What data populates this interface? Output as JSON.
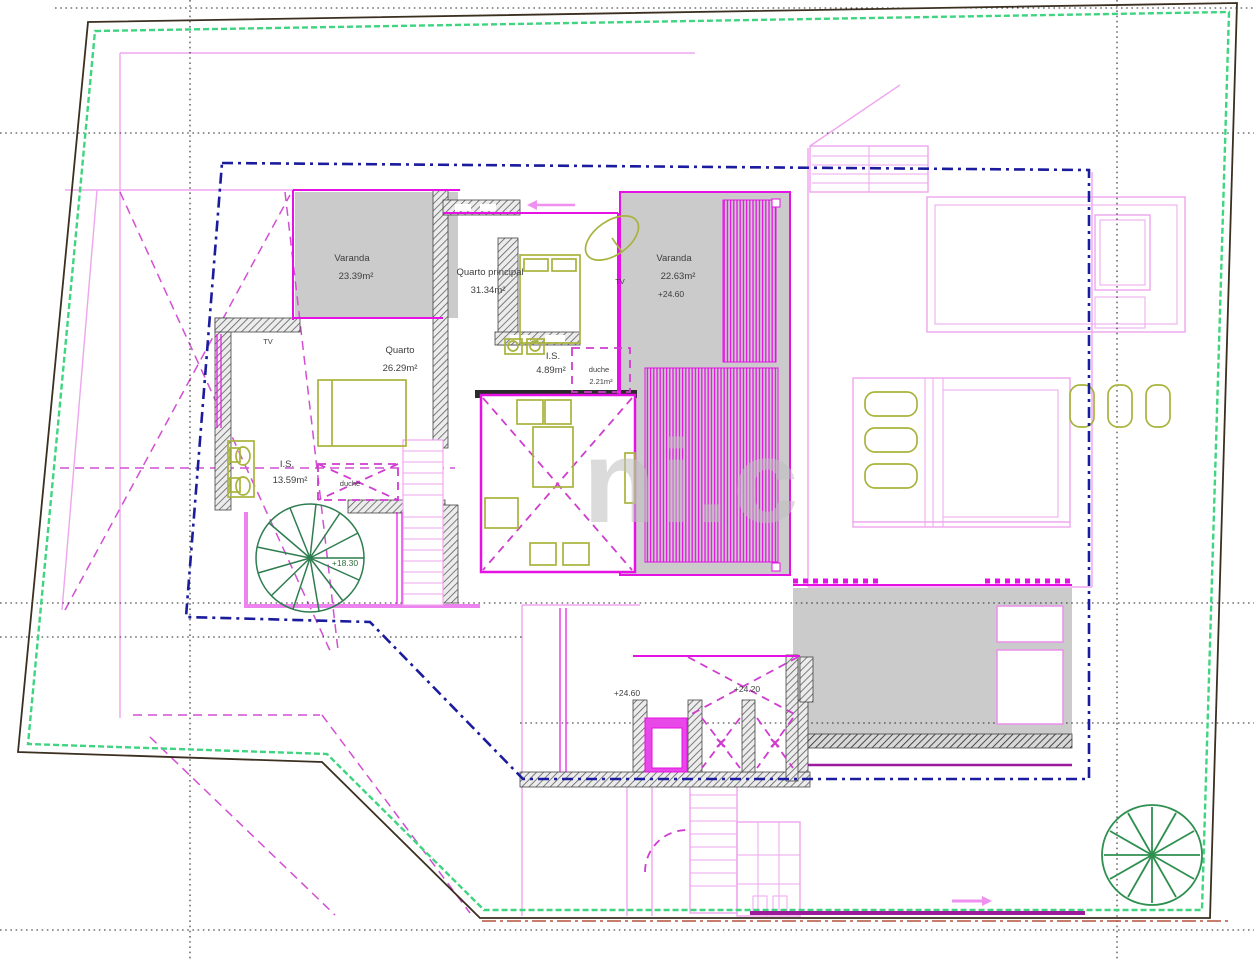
{
  "drawing": {
    "type": "architectural-floor-plan",
    "watermark": "ni.c",
    "rooms": [
      {
        "name": "Varanda",
        "area": "23.39m²"
      },
      {
        "name": "Quarto principal",
        "area": "31.34m²"
      },
      {
        "name": "Varanda",
        "area": "22.63m²",
        "level": "+24.60"
      },
      {
        "name": "Quarto",
        "area": "26.29m²"
      },
      {
        "name": "I.S.",
        "area": "4.89m²"
      },
      {
        "name": "duche",
        "area": "2.21m²"
      },
      {
        "name": "I.S.",
        "area": "13.59m²"
      },
      {
        "name": "duche"
      }
    ],
    "levels": {
      "spiral_stair": "+18.30",
      "hall": "+24.60",
      "upper_void": "+24.20"
    },
    "annotations": {
      "tv": "TV"
    },
    "icons": {
      "tree": "tree-icon",
      "spiral_stair": "spiral-stair-icon",
      "entry_arrow": "arrow-right-icon",
      "door_slide_arrow": "arrow-left-icon"
    },
    "colors": {
      "boundary_green": "#3fd47f",
      "setback_blue": "#1b1b9e",
      "wall_magenta": "#e511e5",
      "lower_level_pink": "#efa5ef",
      "furniture_olive": "#a9b33c",
      "slab_gray": "#cbcbcb",
      "landscape_green": "#2e7d4f",
      "road_red": "#b5503a",
      "watermark_gray": "#bfbfbf"
    }
  }
}
